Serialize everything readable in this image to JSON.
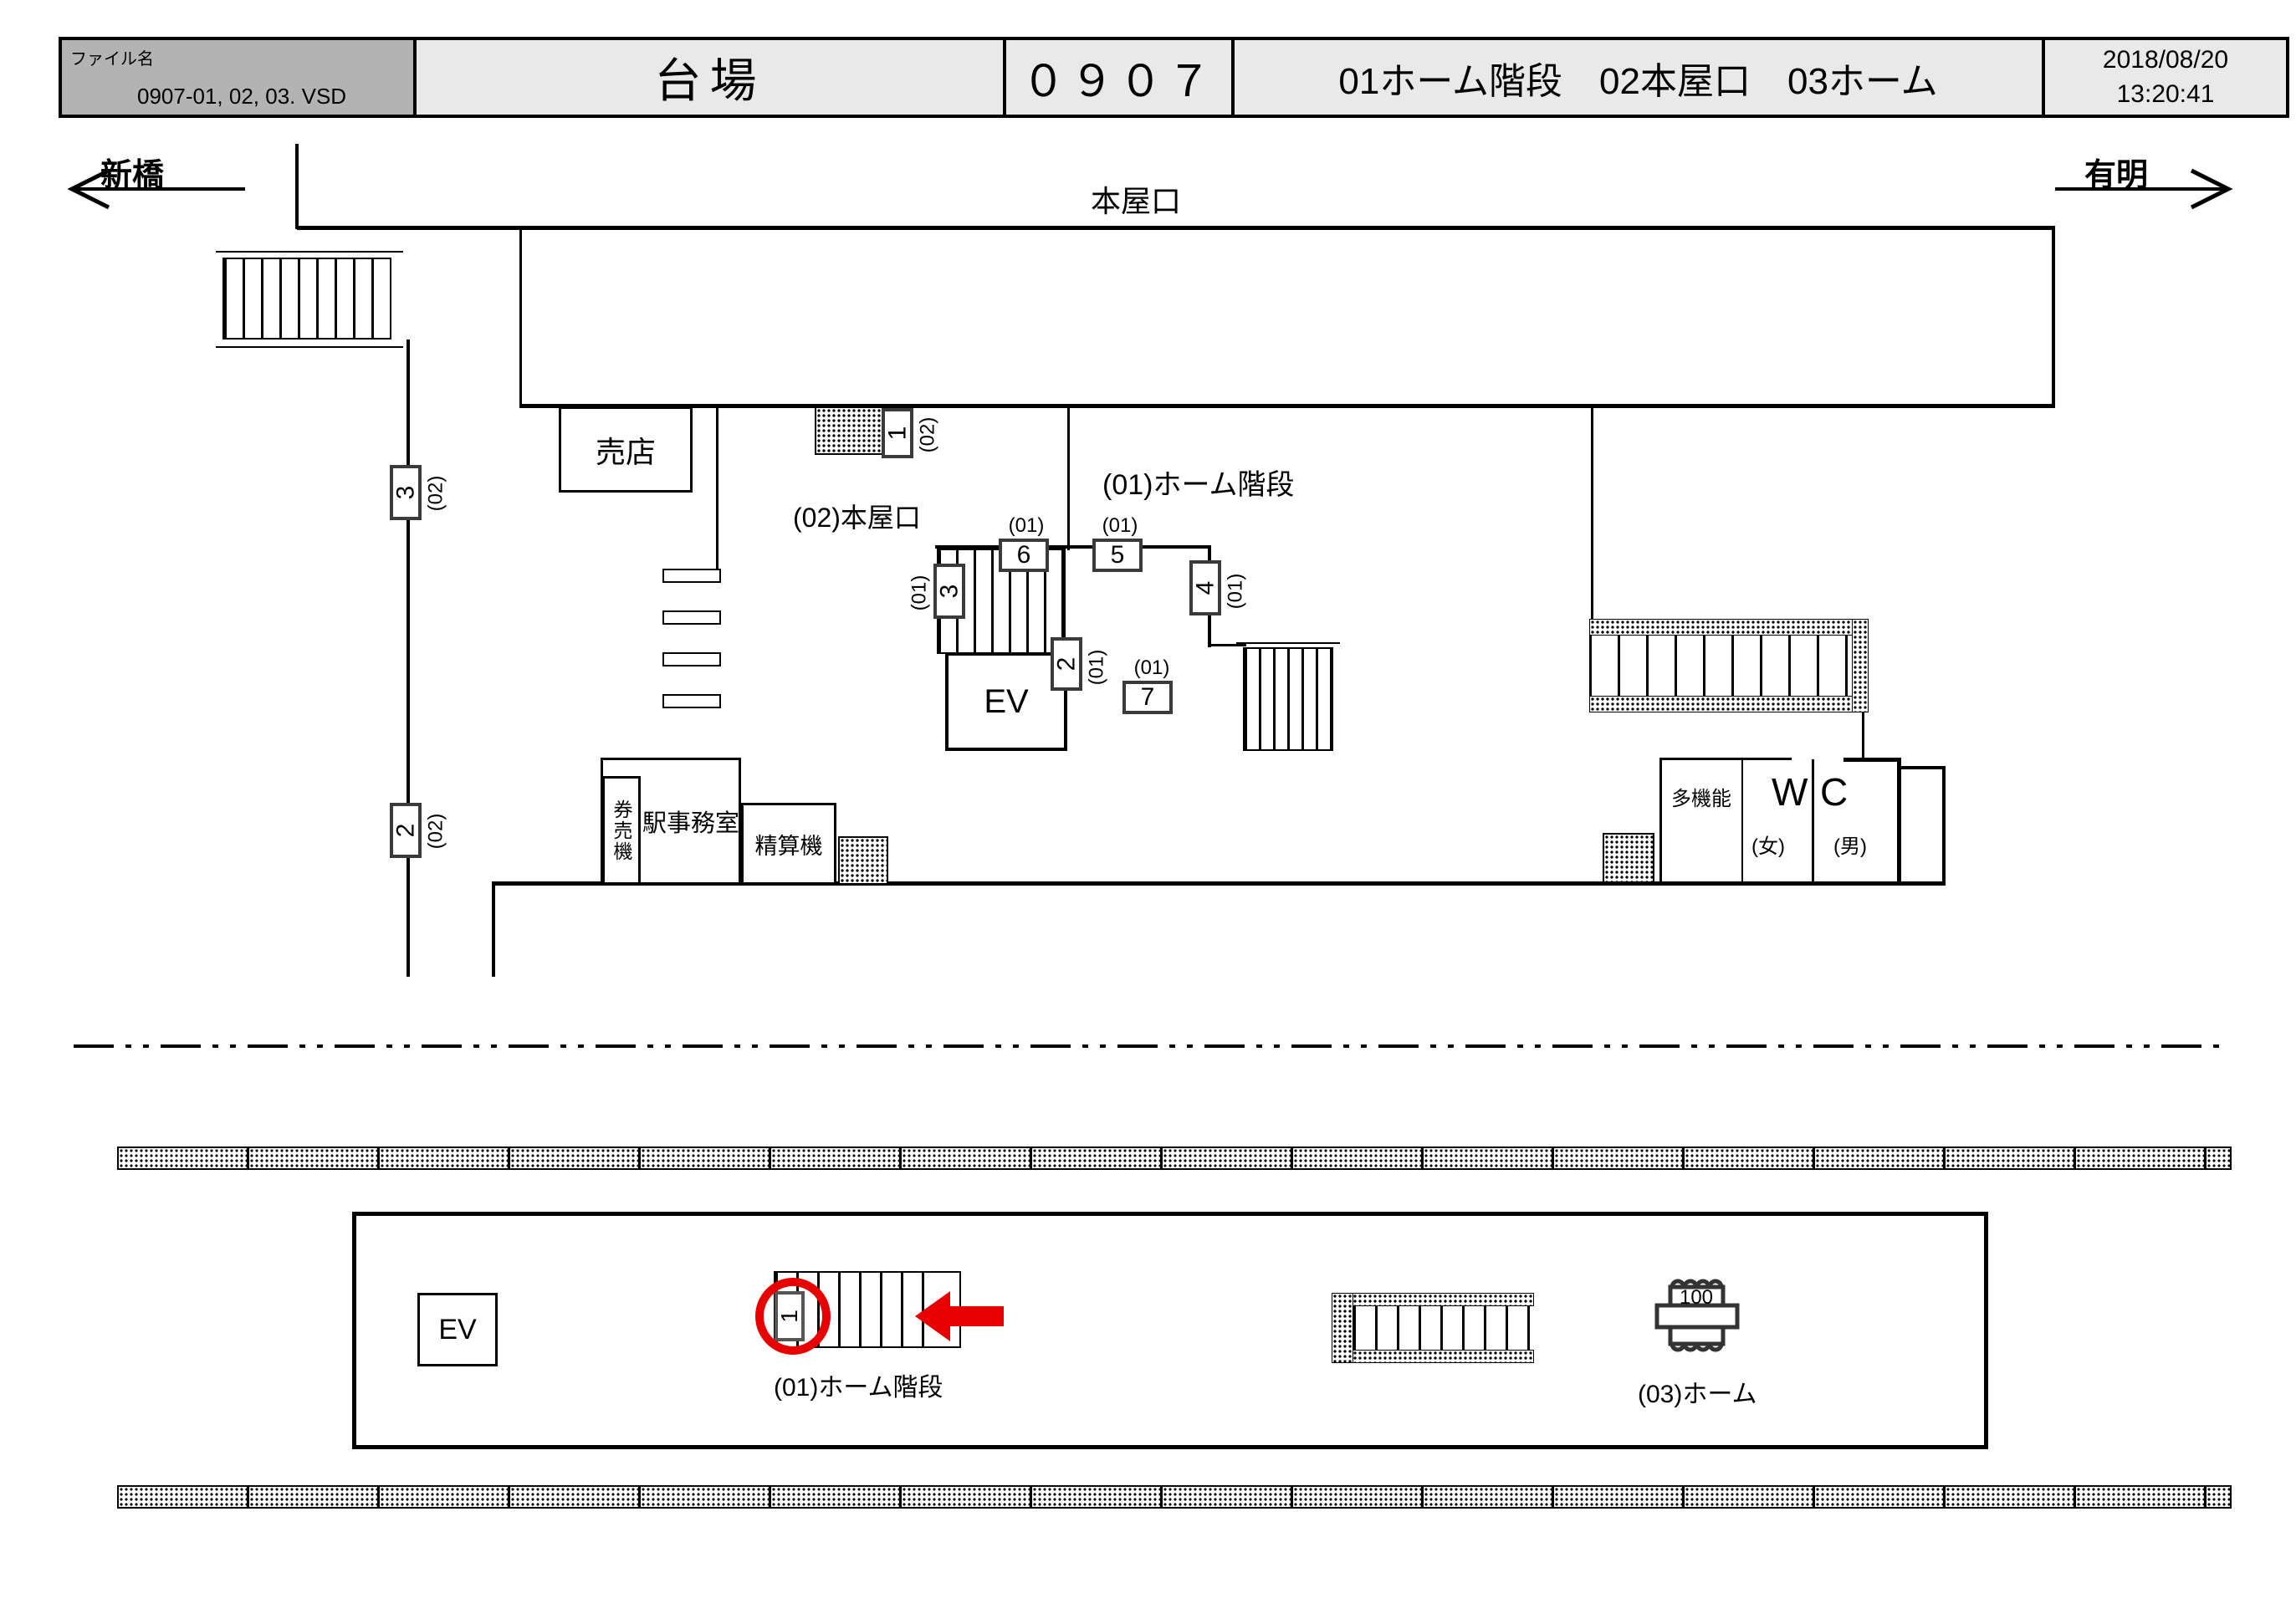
{
  "header": {
    "file_label": "ファイル名",
    "file_name": "0907-01, 02, 03. VSD",
    "station_name": "台場",
    "station_code": "０９０７",
    "view_titles": "01ホーム階段　02本屋口　03ホーム",
    "date": "2018/08/20",
    "time": "13:20:41"
  },
  "directions": {
    "left": "新橋",
    "right": "有明"
  },
  "concourse": {
    "entrance_label": "本屋口",
    "shop": "売店",
    "area01_label": "(01)ホーム階段",
    "area02_label": "(02)本屋口",
    "ev": "EV",
    "office": "駅事務室",
    "ticket_machine": "券売機",
    "fare_machine": "精算機",
    "multifunction": "多機能",
    "wc_left": "W",
    "wc_right": "C",
    "female": "(女)",
    "male": "(男)"
  },
  "cameras": {
    "c1_02": {
      "num": "1",
      "tag": "(02)"
    },
    "c3_02": {
      "num": "3",
      "tag": "(02)"
    },
    "c2_02": {
      "num": "2",
      "tag": "(02)"
    },
    "c3_01": {
      "num": "3",
      "tag": "(01)"
    },
    "c6_01": {
      "num": "6",
      "tag": "(01)"
    },
    "c5_01": {
      "num": "5",
      "tag": "(01)"
    },
    "c4_01": {
      "num": "4",
      "tag": "(01)"
    },
    "c2_01": {
      "num": "2",
      "tag": "(01)"
    },
    "c7_01": {
      "num": "7",
      "tag": "(01)"
    }
  },
  "platform": {
    "ev": "EV",
    "stairs_label": "(01)ホーム階段",
    "platform_label": "(03)ホーム",
    "camera_1": "1",
    "camera_100": "100"
  },
  "colors": {
    "highlight": "#e60000",
    "header_gray": "#b3b3b3",
    "header_light": "#e9e9e9"
  }
}
